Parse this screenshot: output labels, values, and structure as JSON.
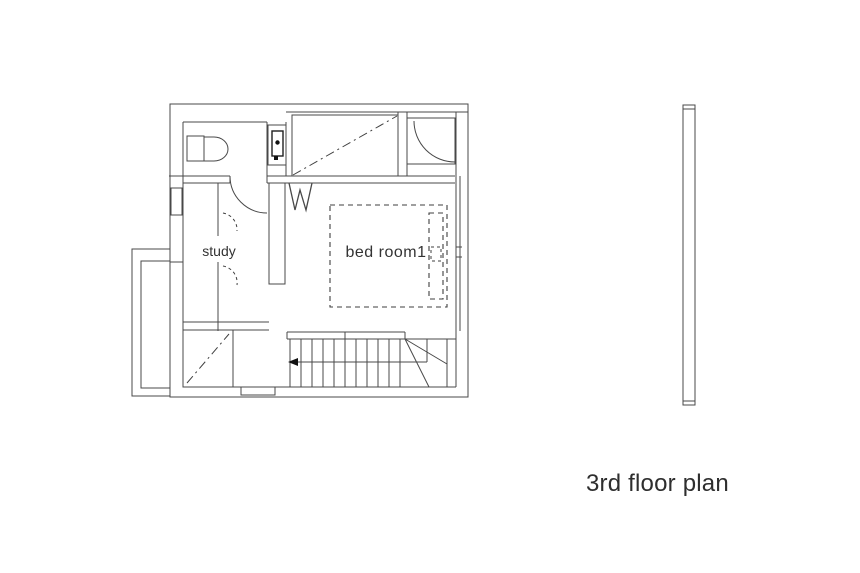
{
  "drawing": {
    "title": "3rd floor plan",
    "room_labels": {
      "study": "study",
      "bedroom1": "bed room1"
    },
    "colors": {
      "background": "#ffffff",
      "line": "#484848",
      "text": "#333333"
    },
    "elements": [
      "toilet",
      "washbasin",
      "closet",
      "closet-door-swing",
      "study-door-swing",
      "study-desk",
      "bed",
      "w-mark",
      "staircase",
      "stair-direction-arrow",
      "void-shaft",
      "balcony",
      "section-marker"
    ]
  }
}
